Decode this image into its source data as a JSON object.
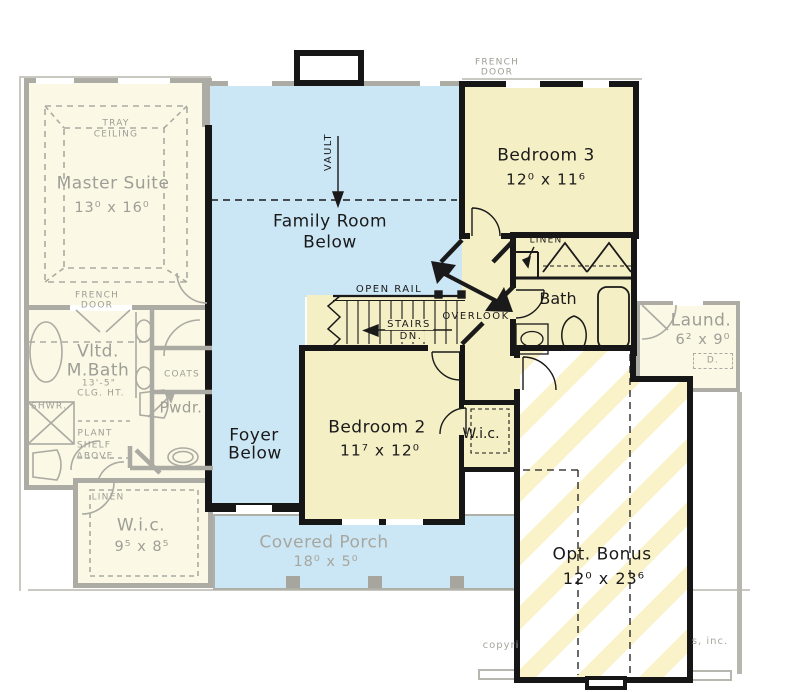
{
  "colors": {
    "active_fill": "#F5EFC5",
    "ghost_fill": "#FBF8E5",
    "blue_fill": "#CBE6F5",
    "stripe_yellow": "#FAF3C9",
    "wall_black": "#161616",
    "wall_ghost": "#ACACA4"
  },
  "rooms": {
    "master_suite": {
      "name": "Master Suite",
      "dims": "13⁰ x 16⁰"
    },
    "family_room": {
      "line1": "Family Room",
      "line2": "Below"
    },
    "foyer": {
      "line1": "Foyer",
      "line2": "Below"
    },
    "bedroom_3": {
      "name": "Bedroom 3",
      "dims": "12⁰ x 11⁶"
    },
    "bedroom_2": {
      "name": "Bedroom 2",
      "dims": "11⁷ x 12⁰"
    },
    "bath": {
      "name": "Bath"
    },
    "wic_upper": {
      "name": "W.i.c."
    },
    "wic_master": {
      "name": "W.i.c.",
      "dims": "9⁵ x 8⁵"
    },
    "master_bath": {
      "line1": "Vltd.",
      "line2": "M.Bath",
      "line3": "13'-5\"",
      "line4": "CLG. HT."
    },
    "powder": {
      "name": "Pwdr."
    },
    "laundry": {
      "name": "Laund.",
      "dims": "6² x 9⁰",
      "dryer": "D."
    },
    "bonus": {
      "name": "Opt. Bonus",
      "dims": "12⁰ x 23⁶"
    },
    "porch": {
      "name": "Covered Porch",
      "dims": "18⁰ x 5⁰"
    }
  },
  "annotations": {
    "tray_line1": "TRAY",
    "tray_line2": "CEILING",
    "french_door_line1": "FRENCH",
    "french_door_line2": "DOOR",
    "vault": "VAULT",
    "open_rail": "OPEN RAIL",
    "stairs_line1": "STAIRS",
    "stairs_line2": "DN.",
    "overlook": "OVERLOOK",
    "linen": "LINEN",
    "coats": "COATS",
    "shower": "SHWR.",
    "plant_line1": "PLANT",
    "plant_line2": "SHELF",
    "plant_line3": "ABOVE",
    "copyright_left": "copyri",
    "copyright_right": "s, inc."
  }
}
